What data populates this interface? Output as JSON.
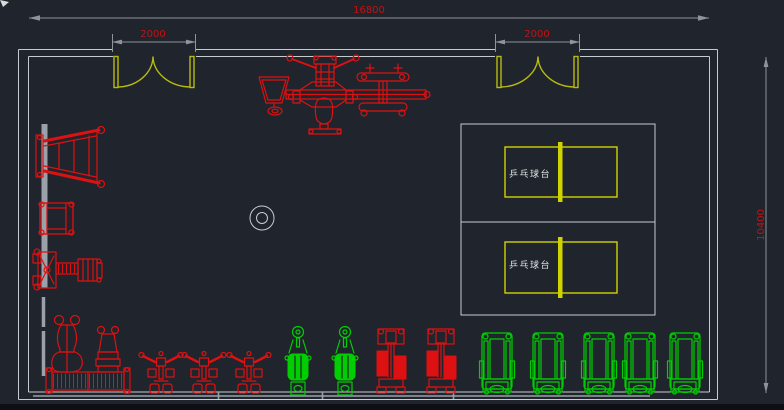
{
  "drawing": {
    "type": "gym-floor-plan",
    "units": "mm"
  },
  "plan": {
    "dim_total_width": "16800",
    "dim_door_left": "2000",
    "dim_door_right": "2000",
    "dim_total_height": "10400",
    "pingpong_label_1": "乒乓球台",
    "pingpong_label_2": "乒乓球台"
  },
  "colors": {
    "background": "#20242c",
    "wall": "#c8cbce",
    "dim_line": "#8e949a",
    "dim_text": "#c41212",
    "equipment_red": "#dd1111",
    "equipment_green": "#00ce00",
    "door_yellow": "#b8bb0e",
    "table_yellow": "#d0d300",
    "label_white": "#dfe3e6",
    "window_bar": "#9aa1a8",
    "edge_strip": "#0c0f13",
    "blue_tick": "#2757d6",
    "cursor": "#d8dadc"
  },
  "equipment_icons": [
    {
      "name": "double-door-icon",
      "count": 2,
      "color_key": "door_yellow"
    },
    {
      "name": "pingpong-table-icon",
      "count": 2,
      "color_key": "table_yellow"
    },
    {
      "name": "column-icon",
      "count": 1,
      "color_key": "wall"
    },
    {
      "name": "ladder-bench-icon",
      "count": 1,
      "color_key": "equipment_red"
    },
    {
      "name": "squat-frame-icon",
      "count": 1,
      "color_key": "equipment_red"
    },
    {
      "name": "row-machine-icon",
      "count": 1,
      "color_key": "equipment_red"
    },
    {
      "name": "adjustable-bench-icon",
      "count": 2,
      "color_key": "equipment_red"
    },
    {
      "name": "barbell-rack-icon",
      "count": 1,
      "color_key": "equipment_red"
    },
    {
      "name": "multi-station-gym-icon",
      "count": 1,
      "color_key": "equipment_red"
    },
    {
      "name": "cable-station-icon",
      "count": 3,
      "color_key": "equipment_red"
    },
    {
      "name": "weight-stack-machine-icon",
      "count": 2,
      "color_key": "equipment_red"
    },
    {
      "name": "exercise-bike-icon",
      "count": 2,
      "color_key": "equipment_green"
    },
    {
      "name": "treadmill-icon",
      "count": 5,
      "color_key": "equipment_green"
    }
  ]
}
